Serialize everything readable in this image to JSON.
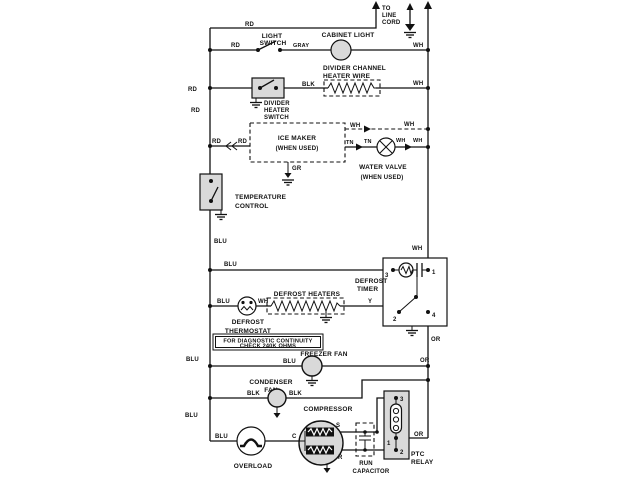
{
  "diagram": {
    "kind": "refrigerator wiring schematic",
    "ink_color": "#111111",
    "background_color": "#ffffff",
    "labels": {
      "top": {
        "rd1": "RD",
        "to1": "TO",
        "to2": "LINE",
        "to3": "CORD",
        "light1": "LIGHT",
        "light2": "SWITCH",
        "rd2": "RD",
        "gray": "GRAY",
        "cabinet": "CABINET LIGHT",
        "wh": "WH"
      },
      "divider": {
        "rd": "RD",
        "ch1": "DIVIDER CHANNEL",
        "ch2": "HEATER WIRE",
        "blk": "BLK",
        "wh": "WH",
        "sw1": "DIVIDER",
        "sw2": "HEATER",
        "sw3": "SWITCH",
        "rd_vert": "RD"
      },
      "icemaker": {
        "rd1": "RD",
        "rd2": "RD",
        "box1": "ICE MAKER",
        "box2": "(WHEN USED)",
        "wh1": "WH",
        "wh2": "WH",
        "tn1": "TN",
        "tn2": "TN",
        "wh3": "WH",
        "wh4": "WH",
        "wv1": "WATER VALVE",
        "wv2": "(WHEN USED)",
        "gr": "GR"
      },
      "tempcontrol": {
        "l1": "TEMPERATURE",
        "l2": "CONTROL",
        "blu": "BLU"
      },
      "timer": {
        "wh": "WH",
        "blu": "BLU",
        "name1": "DEFROST",
        "name2": "TIMER",
        "t1": "1",
        "t2": "2",
        "t3": "3",
        "t4": "4",
        "or": "OR",
        "y": "Y"
      },
      "defrost": {
        "heaters": "DEFROST HEATERS",
        "blu": "BLU",
        "wh": "WH",
        "th1": "DEFROST",
        "th2": "THERMOSTAT",
        "note1": "FOR DIAGNOSTIC CONTINUITY",
        "note2": "CHECK 240K OHMS"
      },
      "freezer": {
        "name": "FREEZER FAN",
        "blu_left": "BLU",
        "blu": "BLU",
        "or": "OR"
      },
      "condenser": {
        "name1": "CONDENSER",
        "name2": "FAN",
        "blk1": "BLK",
        "blk2": "BLK"
      },
      "bottom": {
        "blu_left": "BLU",
        "blu": "BLU",
        "overload": "OVERLOAD",
        "c": "C",
        "compressor": "COMPRESSOR",
        "s": "S",
        "r": "R",
        "cap1": "RUN",
        "cap2": "CAPACITOR",
        "relay1": "PTC",
        "relay2": "RELAY",
        "r1": "1",
        "r2": "2",
        "r3": "3",
        "or": "OR"
      }
    }
  }
}
